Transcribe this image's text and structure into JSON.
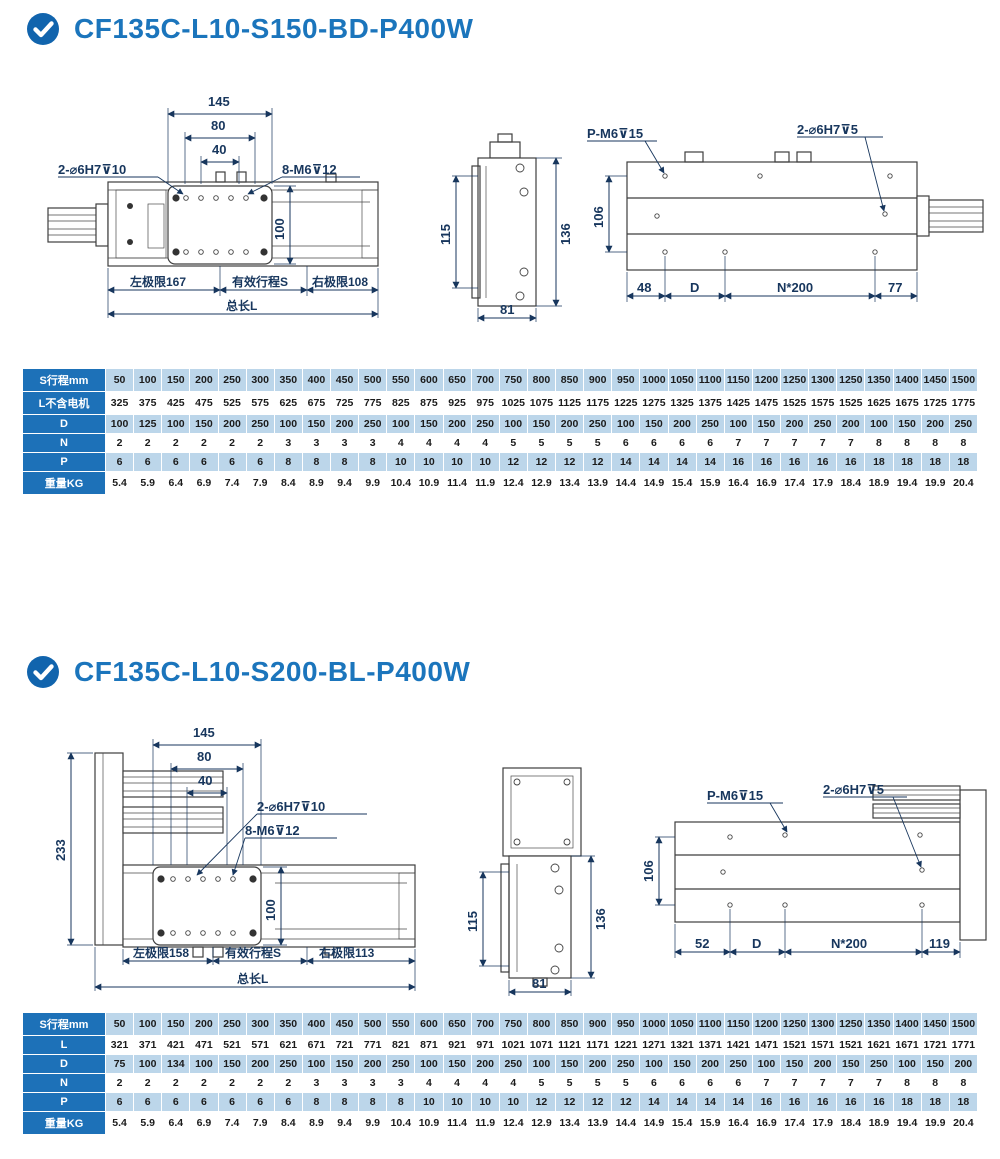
{
  "page": {
    "accent": "#1b75bc",
    "check_circle_color": "#1164ad",
    "table_header_bg": "#1d71b8",
    "row_shade": "#bcd6ea"
  },
  "sections": [
    {
      "title": "CF135C-L10-S150-BD-P400W",
      "icon": "check-circle",
      "drawing": {
        "front": {
          "dim_145": "145",
          "dim_80": "80",
          "dim_40": "40",
          "holes_label": "2-⌀6H7⊽10",
          "screws_label": "8-M6⊽12",
          "dim_100": "100",
          "left_limit": "左极限167",
          "stroke": "有效行程S",
          "right_limit": "右极限108",
          "total": "总长L"
        },
        "side": {
          "dim_115": "115",
          "dim_136": "136",
          "dim_81": "81"
        },
        "bottom": {
          "thread_label": "P-M6⊽15",
          "pin_label": "2-⌀6H7⊽5",
          "dim_106": "106",
          "seg_1": "48",
          "seg_2": "D",
          "seg_3": "N*200",
          "seg_4": "77"
        }
      },
      "table": {
        "rows": [
          {
            "label": "S行程mm",
            "values": [
              50,
              100,
              150,
              200,
              250,
              300,
              350,
              400,
              450,
              500,
              550,
              600,
              650,
              700,
              750,
              800,
              850,
              900,
              950,
              1000,
              1050,
              1100,
              1150,
              1200,
              1250,
              1300,
              1250,
              1350,
              1400,
              1450,
              1500
            ]
          },
          {
            "label": "L不含电机",
            "values": [
              325,
              375,
              425,
              475,
              525,
              575,
              625,
              675,
              725,
              775,
              825,
              875,
              925,
              975,
              1025,
              1075,
              1125,
              1175,
              1225,
              1275,
              1325,
              1375,
              1425,
              1475,
              1525,
              1575,
              1525,
              1625,
              1675,
              1725,
              1775
            ]
          },
          {
            "label": "D",
            "values": [
              100,
              125,
              100,
              150,
              200,
              250,
              100,
              150,
              200,
              250,
              100,
              150,
              200,
              250,
              100,
              150,
              200,
              250,
              100,
              150,
              200,
              250,
              100,
              150,
              200,
              250,
              200,
              100,
              150,
              200,
              250
            ]
          },
          {
            "label": "N",
            "values": [
              2,
              2,
              2,
              2,
              2,
              2,
              3,
              3,
              3,
              3,
              4,
              4,
              4,
              4,
              5,
              5,
              5,
              5,
              6,
              6,
              6,
              6,
              7,
              7,
              7,
              7,
              7,
              8,
              8,
              8,
              8
            ]
          },
          {
            "label": "P",
            "values": [
              6,
              6,
              6,
              6,
              6,
              6,
              8,
              8,
              8,
              8,
              10,
              10,
              10,
              10,
              12,
              12,
              12,
              12,
              14,
              14,
              14,
              14,
              16,
              16,
              16,
              16,
              16,
              18,
              18,
              18,
              18
            ]
          },
          {
            "label": "重量KG",
            "values": [
              5.4,
              5.9,
              6.4,
              6.9,
              7.4,
              7.9,
              8.4,
              8.9,
              9.4,
              9.9,
              10.4,
              10.9,
              11.4,
              11.9,
              12.4,
              12.9,
              13.4,
              13.9,
              14.4,
              14.9,
              15.4,
              15.9,
              16.4,
              16.9,
              17.4,
              17.9,
              18.4,
              18.9,
              19.4,
              19.9,
              20.4
            ]
          }
        ]
      }
    },
    {
      "title": "CF135C-L10-S200-BL-P400W",
      "icon": "check-circle",
      "drawing": {
        "front": {
          "dim_145": "145",
          "dim_80": "80",
          "dim_40": "40",
          "dim_233": "233",
          "holes_label": "2-⌀6H7⊽10",
          "screws_label": "8-M6⊽12",
          "dim_100": "100",
          "left_limit": "左极限158",
          "stroke": "有效行程S",
          "right_limit": "右极限113",
          "total": "总长L"
        },
        "side": {
          "dim_115": "115",
          "dim_136": "136",
          "dim_81": "81"
        },
        "bottom": {
          "thread_label": "P-M6⊽15",
          "pin_label": "2-⌀6H7⊽5",
          "dim_106": "106",
          "seg_1": "52",
          "seg_2": "D",
          "seg_3": "N*200",
          "seg_4": "119"
        }
      },
      "table": {
        "rows": [
          {
            "label": "S行程mm",
            "values": [
              50,
              100,
              150,
              200,
              250,
              300,
              350,
              400,
              450,
              500,
              550,
              600,
              650,
              700,
              750,
              800,
              850,
              900,
              950,
              1000,
              1050,
              1100,
              1150,
              1200,
              1250,
              1300,
              1250,
              1350,
              1400,
              1450,
              1500
            ]
          },
          {
            "label": "L",
            "values": [
              321,
              371,
              421,
              471,
              521,
              571,
              621,
              671,
              721,
              771,
              821,
              871,
              921,
              971,
              1021,
              1071,
              1121,
              1171,
              1221,
              1271,
              1321,
              1371,
              1421,
              1471,
              1521,
              1571,
              1521,
              1621,
              1671,
              1721,
              1771
            ]
          },
          {
            "label": "D",
            "values": [
              75,
              100,
              134,
              100,
              150,
              200,
              250,
              100,
              150,
              200,
              250,
              100,
              150,
              200,
              250,
              100,
              150,
              200,
              250,
              100,
              150,
              200,
              250,
              100,
              150,
              200,
              150,
              250,
              100,
              150,
              200
            ]
          },
          {
            "label": "N",
            "values": [
              2,
              2,
              2,
              2,
              2,
              2,
              2,
              3,
              3,
              3,
              3,
              4,
              4,
              4,
              4,
              5,
              5,
              5,
              5,
              6,
              6,
              6,
              6,
              7,
              7,
              7,
              7,
              7,
              8,
              8,
              8
            ]
          },
          {
            "label": "P",
            "values": [
              6,
              6,
              6,
              6,
              6,
              6,
              6,
              8,
              8,
              8,
              8,
              10,
              10,
              10,
              10,
              12,
              12,
              12,
              12,
              14,
              14,
              14,
              14,
              16,
              16,
              16,
              16,
              16,
              18,
              18,
              18
            ]
          },
          {
            "label": "重量KG",
            "values": [
              5.4,
              5.9,
              6.4,
              6.9,
              7.4,
              7.9,
              8.4,
              8.9,
              9.4,
              9.9,
              10.4,
              10.9,
              11.4,
              11.9,
              12.4,
              12.9,
              13.4,
              13.9,
              14.4,
              14.9,
              15.4,
              15.9,
              16.4,
              16.9,
              17.4,
              17.9,
              18.4,
              18.9,
              19.4,
              19.9,
              20.4
            ]
          }
        ]
      }
    }
  ]
}
